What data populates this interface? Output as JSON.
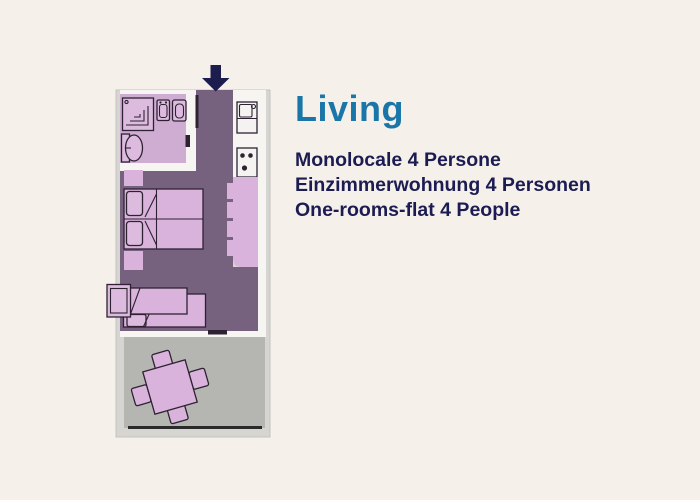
{
  "title": "Living",
  "description_lines": [
    "Monolocale 4 Persone",
    "Einzimmerwohnung 4 Personen",
    "One-rooms-flat 4 People"
  ],
  "colors": {
    "background": "#f5f1ea",
    "title": "#1a76a8",
    "text": "#1c1c52",
    "sheet": "#d6d5d1",
    "wall": "#f6f5f2",
    "floor": "#76617f",
    "bathroom": "#cfadd2",
    "furniture": "#d9b3dc",
    "furniture_light": "#ddbbdf",
    "terrace": "#b5b6b1",
    "outline": "#2e2232",
    "arrow": "#1c1c4e",
    "railing": "#2a2a2a"
  }
}
